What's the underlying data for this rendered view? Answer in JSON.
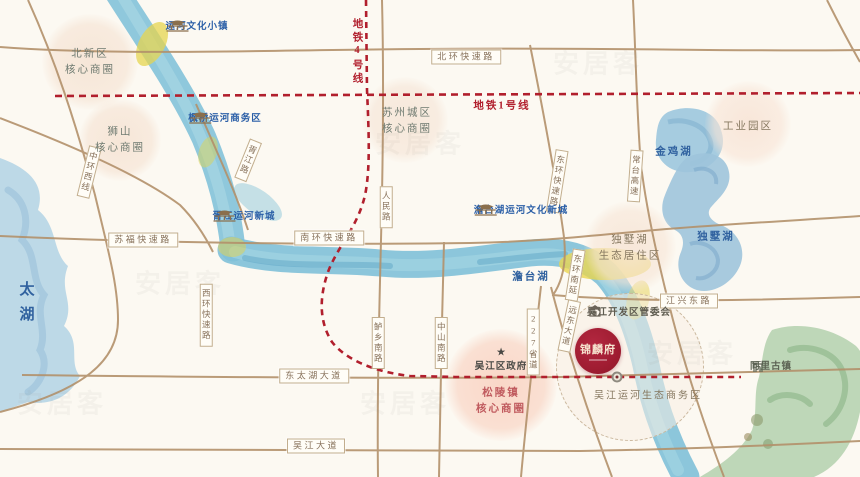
{
  "watermark": "安居客",
  "lakes": {
    "taihu": "太湖",
    "jinji": "金鸡湖",
    "dushu": "独墅湖",
    "tantai": "澹台湖"
  },
  "metro": {
    "line1": "地铁1号线",
    "line4": "地铁4号线"
  },
  "roads": {
    "beihuan": "北环快速路",
    "sufu": "苏福快速路",
    "nanhuan": "南环快速路",
    "jiangxing": "江兴东路",
    "dongtaihu": "东太湖大道",
    "wujiang": "吴江大道",
    "zhonghuanxi": "中环西线",
    "xujianglu": "胥江路",
    "xihuan": "西环快速路",
    "renmin": "人民路",
    "donghuan": "东环快速路",
    "changtai": "常台高速",
    "dongnanyan": "东环南延",
    "luxiang": "鲈乡南路",
    "zhongshan": "中山南路",
    "s227": "227省道",
    "yuandong": "远东大道"
  },
  "landmarks": {
    "yunhe_town": "运河文化小镇",
    "fengqiao": "枫桥运河商务区",
    "xujiang_newtown": "胥江运河新城",
    "tantai_newtown": "澹台湖运河文化新城",
    "kaifaqu": "吴江开发区管委会",
    "tongli": "同里古镇",
    "government": "吴江区政府"
  },
  "districts": {
    "beixin": "北新区\n核心商圈",
    "shishan": "狮山\n核心商圈",
    "suzhou_city": "苏州城区\n核心商圈",
    "industrial_park": "工业园区",
    "dushu_eco": "独墅湖\n生态居住区",
    "songling": "松陵镇\n核心商圈",
    "wujiang_eco": "吴江运河生态商务区"
  },
  "project": {
    "logo": "锦麟府"
  }
}
